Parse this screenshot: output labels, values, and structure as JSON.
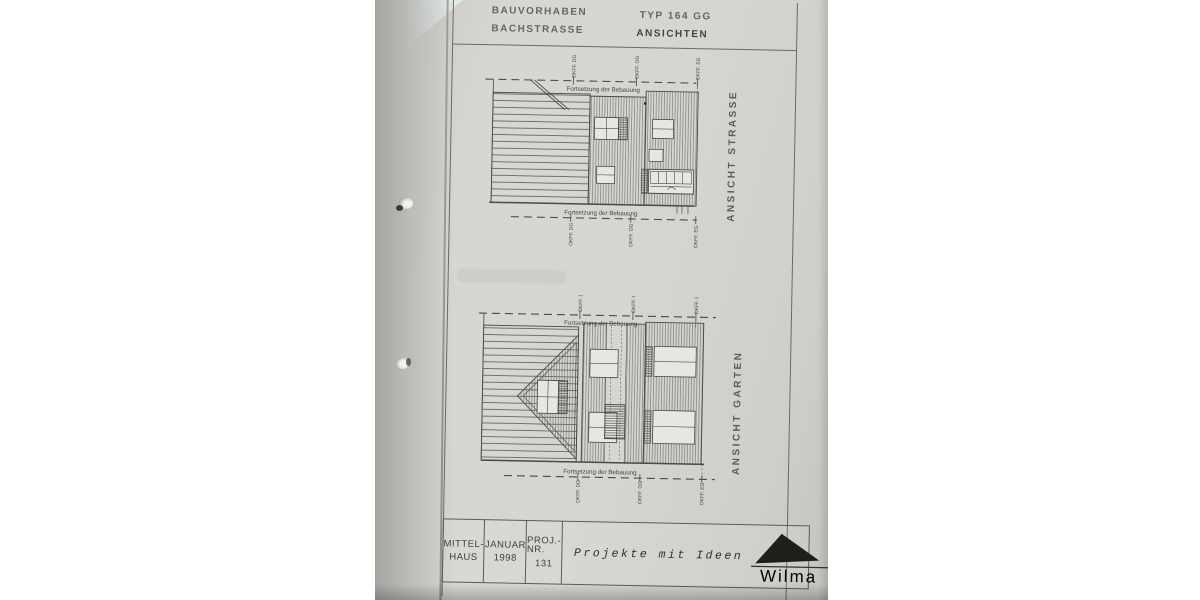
{
  "header": {
    "project_line1": "BAUVORHABEN",
    "project_line2": "BACHSTRASSE",
    "type_label": "TYP 164 GG",
    "sheet_label": "ANSICHTEN"
  },
  "elevations": [
    {
      "title": "ANSICHT STRASSE",
      "continuation_top": "Fortsetzung der Bebauung",
      "continuation_bottom": "Fortsetzung der Bebauung",
      "levels_top": [
        "OKFF. DG",
        "OKFF. OG",
        "OKFF. EG"
      ],
      "levels_bottom": [
        "OKFF. DG",
        "OKFF. OG",
        "OKFF. EG"
      ]
    },
    {
      "title": "ANSICHT GARTEN",
      "continuation_top": "Fortsetzung der Bebauung",
      "continuation_bottom": "Fortsetzung der Bebauung",
      "levels_top": [
        "OKFF. DG",
        "OKFF. OG",
        "OKFF. EG"
      ],
      "levels_bottom": [
        "OKFF. DG",
        "OKFF. OG",
        "OKFF. EG"
      ]
    }
  ],
  "title_block": {
    "cells": [
      {
        "line1": "MITTEL-",
        "line2": "HAUS"
      },
      {
        "line1": "JANUAR",
        "line2": "1998"
      },
      {
        "line1": "PROJ.-NR.",
        "line2": "131"
      }
    ],
    "slogan": "Projekte mit Ideen",
    "brand": "Wilma"
  },
  "colors": {
    "paper": "#d7d5d2",
    "ink": "#4a4a46",
    "logo_black": "#1f1e1b",
    "corner_sheet": "#dde8e4"
  }
}
